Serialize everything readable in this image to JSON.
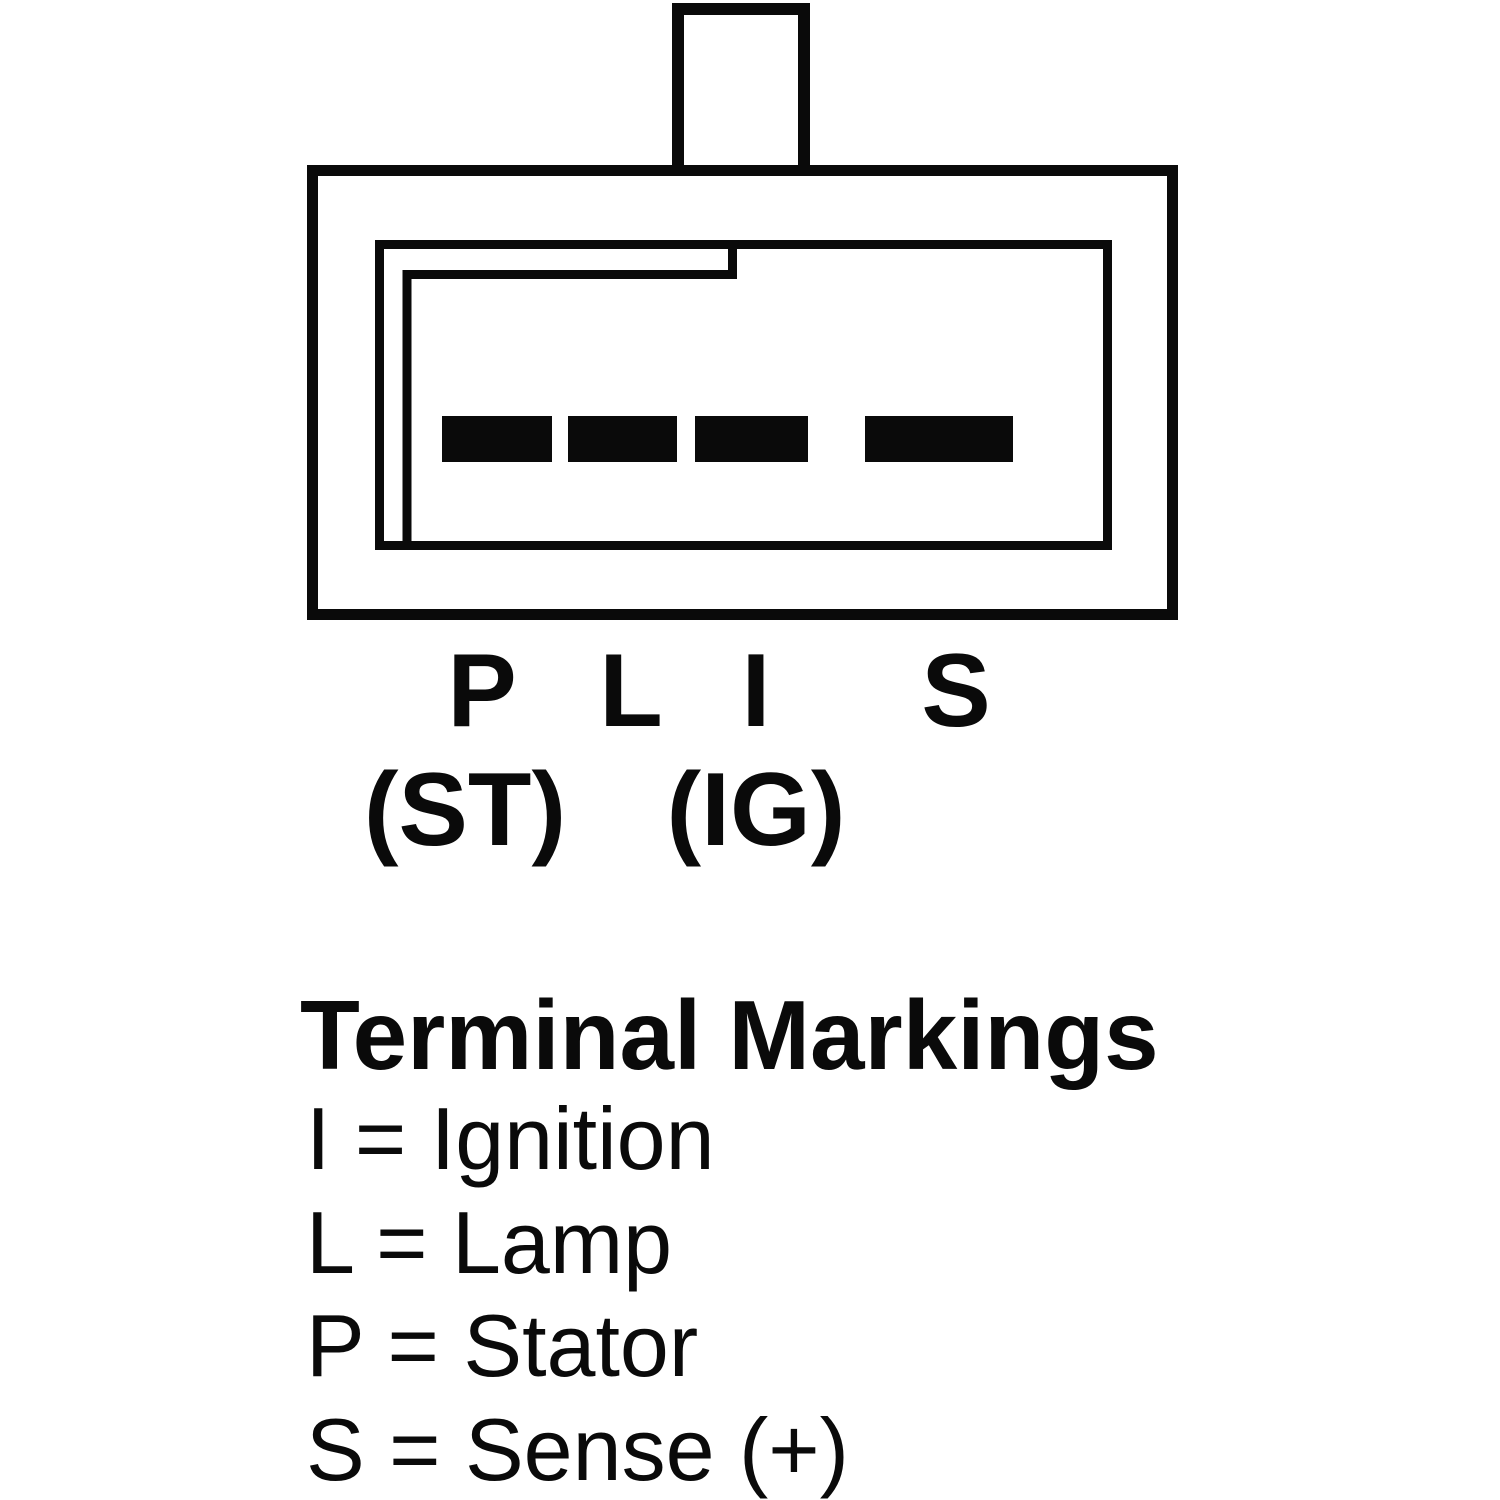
{
  "colors": {
    "ink": "#0a0a0a",
    "background": "#ffffff"
  },
  "connector": {
    "description": "4-terminal alternator plug socket, viewed face-on, keyed housing with locking tab on top",
    "pins": [
      {
        "label": "P",
        "sublabel": "(ST)"
      },
      {
        "label": "L",
        "sublabel": ""
      },
      {
        "label": "I",
        "sublabel": "(IG)"
      },
      {
        "label": "S",
        "sublabel": ""
      }
    ]
  },
  "legend": {
    "title": "Terminal Markings",
    "items": [
      {
        "text": "I = Ignition"
      },
      {
        "text": "L = Lamp"
      },
      {
        "text": "P = Stator"
      },
      {
        "text": "S = Sense (+)"
      }
    ]
  }
}
